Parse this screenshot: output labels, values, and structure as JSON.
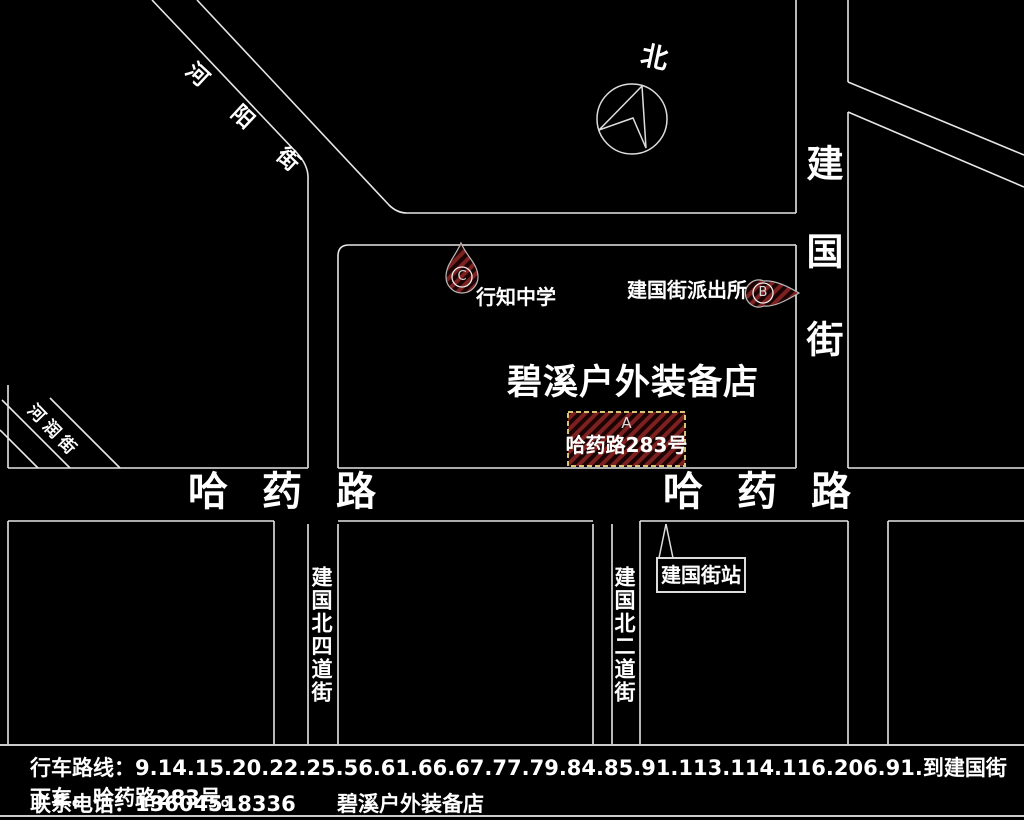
{
  "map": {
    "compass": {
      "label": "北"
    },
    "roads": {
      "heyang_street": "河阳街",
      "herun_street": "河润街",
      "jianguo_street": "建国街",
      "hayao_road_left": "哈药路",
      "hayao_road_right": "哈药路",
      "jianguo_north_4th": "建国北四道街",
      "jianguo_north_2nd": "建国北二道街"
    },
    "markers": {
      "a": {
        "letter": "A",
        "label": "哈药路283号"
      },
      "b": {
        "letter": "B",
        "label": "建国街派出所"
      },
      "c": {
        "letter": "C",
        "label": "行知中学"
      },
      "station": {
        "label": "建国街站"
      }
    },
    "store_title": "碧溪户外装备店"
  },
  "footer": {
    "route": "行车路线：9.14.15.20.22.25.56.61.66.67.77.79.84.85.91.113.114.116.206.91.到建国街下车。哈药路283号。",
    "contact": "联系电话：13604518336",
    "store": "碧溪户外装备店"
  },
  "colors": {
    "background": "#000000",
    "road_line": "#e6e6e6",
    "text": "#ffffff",
    "marker_hatch_stripe": "#7c2020",
    "marker_hatch_dark": "#1c0404",
    "address_box_border": "#d8c478"
  }
}
